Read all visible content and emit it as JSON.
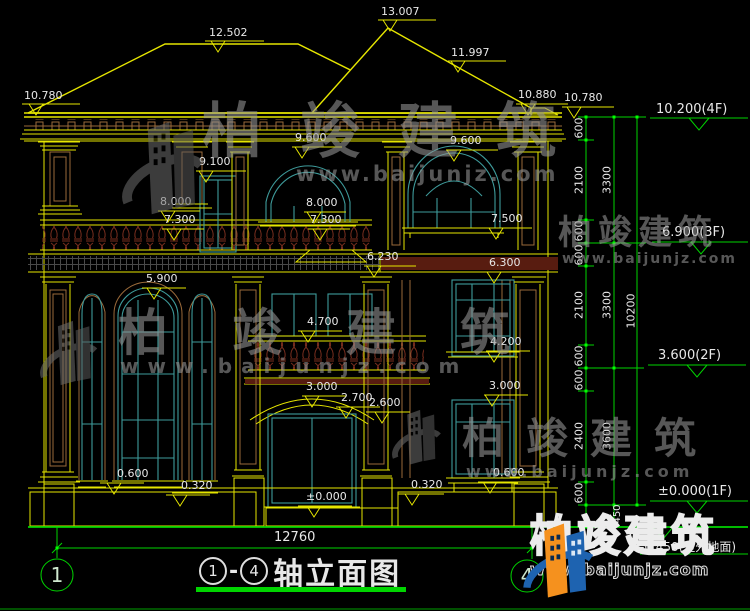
{
  "drawing": {
    "title_axis_start": "1",
    "title_axis_end": "4",
    "title_dash": "-",
    "title_name": "轴立面图",
    "overall_width_dim": "12760",
    "total_height_dim": "10200",
    "plinth_dim": "450",
    "floor_levels": [
      "10.200(4F)",
      "6.900(3F)",
      "3.600(2F)",
      "±0.000(1F)",
      "-0.450(室外地面)"
    ],
    "vertical_chain_dims": [
      "600",
      "2100",
      "600",
      "600",
      "2100",
      "600",
      "600",
      "2400",
      "600"
    ],
    "floor_height_dims": [
      "3300",
      "3300",
      "3600"
    ],
    "roof_elevations": [
      "13.007",
      "12.502",
      "11.997",
      "10.880",
      "10.780",
      "10.780"
    ],
    "facade_elevation_marks": [
      "9.600",
      "9.100",
      "9.600",
      "8.000",
      "8.000",
      "7.300",
      "7.300",
      "7.500",
      "6.230",
      "6.300",
      "5.900",
      "4.700",
      "4.200",
      "3.000",
      "2.700",
      "2.600",
      "3.000",
      "0.600",
      "0.320",
      "0.600",
      "0.320",
      "±0.000"
    ]
  },
  "brand": {
    "name": "柏竣建筑",
    "site": "www.baijunjz.com"
  },
  "axis_bubbles": {
    "left": "1",
    "right": "4"
  },
  "labels": [
    {
      "t": "13.007",
      "x": 381,
      "y": 6
    },
    {
      "t": "12.502",
      "x": 209,
      "y": 27
    },
    {
      "t": "11.997",
      "x": 451,
      "y": 47
    },
    {
      "t": "10.880",
      "x": 518,
      "y": 89
    },
    {
      "t": "10.780",
      "x": 564,
      "y": 92
    },
    {
      "t": "10.780",
      "x": 24,
      "y": 90
    },
    {
      "t": "10.200(4F)",
      "x": 656,
      "y": 103,
      "s": 13
    },
    {
      "t": "9.600",
      "x": 295,
      "y": 132
    },
    {
      "t": "9.100",
      "x": 199,
      "y": 156
    },
    {
      "t": "9.600",
      "x": 450,
      "y": 135
    },
    {
      "t": "8.000",
      "x": 160,
      "y": 196
    },
    {
      "t": "8.000",
      "x": 306,
      "y": 197
    },
    {
      "t": "7.300",
      "x": 164,
      "y": 214
    },
    {
      "t": "7.300",
      "x": 310,
      "y": 214
    },
    {
      "t": "7.500",
      "x": 491,
      "y": 213
    },
    {
      "t": "6.900(3F)",
      "x": 662,
      "y": 226,
      "s": 13
    },
    {
      "t": "6.230",
      "x": 367,
      "y": 251
    },
    {
      "t": "6.300",
      "x": 489,
      "y": 257
    },
    {
      "t": "5.900",
      "x": 146,
      "y": 273
    },
    {
      "t": "4.700",
      "x": 307,
      "y": 316
    },
    {
      "t": "4.200",
      "x": 490,
      "y": 336
    },
    {
      "t": "3.600(2F)",
      "x": 658,
      "y": 349,
      "s": 13
    },
    {
      "t": "3.000",
      "x": 306,
      "y": 381
    },
    {
      "t": "2.700",
      "x": 341,
      "y": 392
    },
    {
      "t": "2.600",
      "x": 369,
      "y": 397
    },
    {
      "t": "3.000",
      "x": 489,
      "y": 380
    },
    {
      "t": "0.600",
      "x": 117,
      "y": 468
    },
    {
      "t": "0.320",
      "x": 181,
      "y": 480
    },
    {
      "t": "0.600",
      "x": 493,
      "y": 467
    },
    {
      "t": "0.320",
      "x": 411,
      "y": 479
    },
    {
      "t": "±0.000",
      "x": 306,
      "y": 491
    },
    {
      "t": "±0.000(1F)",
      "x": 658,
      "y": 485,
      "s": 13
    },
    {
      "t": "-0.450(室外地面)",
      "x": 640,
      "y": 541,
      "s": 12
    },
    {
      "t": "12760",
      "x": 274,
      "y": 531,
      "s": 13
    },
    {
      "t": "600",
      "x": 579,
      "y": 128,
      "r": 1
    },
    {
      "t": "2100",
      "x": 579,
      "y": 180,
      "r": 1
    },
    {
      "t": "600",
      "x": 579,
      "y": 231,
      "r": 1
    },
    {
      "t": "600",
      "x": 579,
      "y": 255,
      "r": 1
    },
    {
      "t": "2100",
      "x": 579,
      "y": 305,
      "r": 1
    },
    {
      "t": "600",
      "x": 579,
      "y": 356,
      "r": 1
    },
    {
      "t": "600",
      "x": 579,
      "y": 380,
      "r": 1
    },
    {
      "t": "2400",
      "x": 579,
      "y": 436,
      "r": 1
    },
    {
      "t": "600",
      "x": 579,
      "y": 493,
      "r": 1
    },
    {
      "t": "3300",
      "x": 607,
      "y": 180,
      "r": 1
    },
    {
      "t": "3300",
      "x": 607,
      "y": 305,
      "r": 1
    },
    {
      "t": "3600",
      "x": 607,
      "y": 436,
      "r": 1
    },
    {
      "t": "450",
      "x": 618,
      "y": 514,
      "r": 1,
      "s": 10
    },
    {
      "t": "10200",
      "x": 631,
      "y": 311,
      "r": 1
    },
    {
      "t": "1",
      "x": 57,
      "y": 575,
      "s": 20,
      "c": "#CFE8CF",
      "k": 1
    },
    {
      "t": "4",
      "x": 527,
      "y": 576,
      "s": 20,
      "c": "#CFE8CF",
      "k": 1
    }
  ],
  "colors": {
    "green": "#00D400",
    "bright_green": "#00FF00",
    "yellow": "#E6E600",
    "teal": "#3E9B9B",
    "brown": "#9A6A3A",
    "maroon": "#7A2E1E",
    "white": "#E8E8E8",
    "logo_orange": "#F5911E",
    "logo_blue": "#1E63B0",
    "bg": "#000000"
  }
}
